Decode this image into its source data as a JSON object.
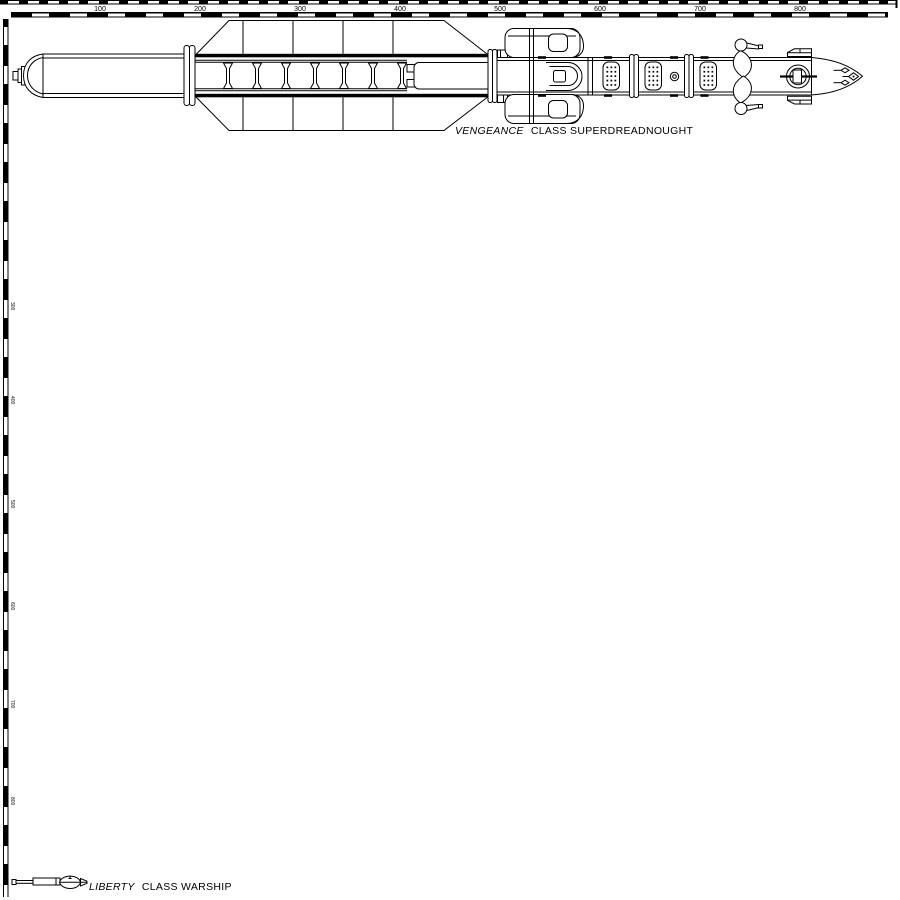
{
  "page": {
    "background": "#ffffff",
    "line_color": "#000000",
    "description": "Ship size comparison line drawing"
  },
  "rulers": {
    "top": {
      "labels": [
        "100",
        "200",
        "300",
        "400",
        "500",
        "600",
        "700",
        "800"
      ]
    },
    "left": {
      "labels": [
        "300",
        "400",
        "500",
        "600",
        "700",
        "800"
      ]
    }
  },
  "ships": {
    "vengeance": {
      "name_italic": "VENGEANCE",
      "name_rest": "CLASS SUPERDREADNOUGHT"
    },
    "liberty": {
      "name_italic": "LIBERTY",
      "name_rest": "CLASS WARSHIP"
    }
  }
}
